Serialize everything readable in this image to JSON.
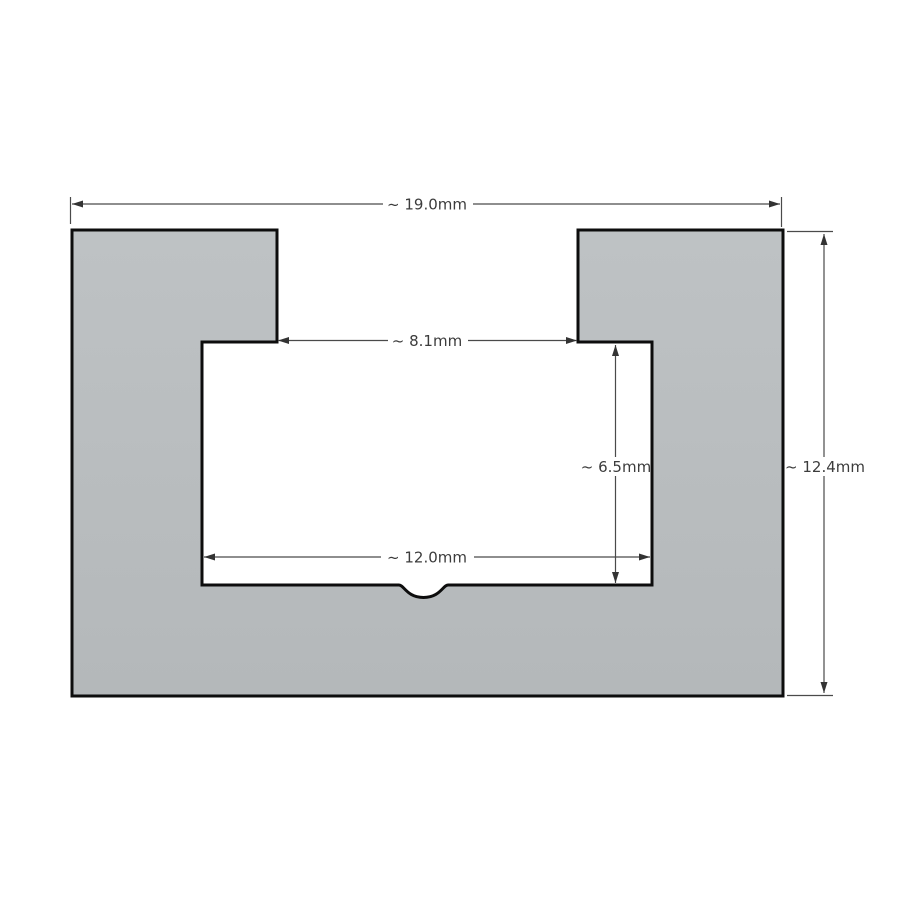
{
  "drawing": {
    "type": "cad-cross-section",
    "description": "T-slot channel cross-section with approximate reference dimensions",
    "units": "mm",
    "colors": {
      "background": "#ffffff",
      "part_fill_top": "#bec2c4",
      "part_fill_bottom": "#b4b8ba",
      "outline": "#0d0d0d",
      "dimension_line": "#4a4a4a",
      "arrow": "#333333",
      "text": "#3c3c3c",
      "label_background": "#ffffff"
    },
    "dimensions": {
      "overall_width": {
        "label": "~ 19.0mm",
        "value": 19.0,
        "approximate": true,
        "orientation": "horizontal",
        "measures": "overall width of part"
      },
      "slot_opening": {
        "label": "~ 8.1mm",
        "value": 8.1,
        "approximate": true,
        "orientation": "horizontal",
        "measures": "slot opening between top tabs"
      },
      "cavity_depth": {
        "label": "~ 6.5mm",
        "value": 6.5,
        "approximate": true,
        "orientation": "vertical",
        "measures": "inner cavity depth"
      },
      "cavity_width": {
        "label": "~ 12.0mm",
        "value": 12.0,
        "approximate": true,
        "orientation": "horizontal",
        "measures": "inner cavity width"
      },
      "overall_height": {
        "label": "~ 12.4mm",
        "value": 12.4,
        "approximate": true,
        "orientation": "vertical",
        "measures": "overall height of part"
      }
    },
    "features": {
      "notch": "small semicircular notch centered on cavity floor"
    }
  }
}
